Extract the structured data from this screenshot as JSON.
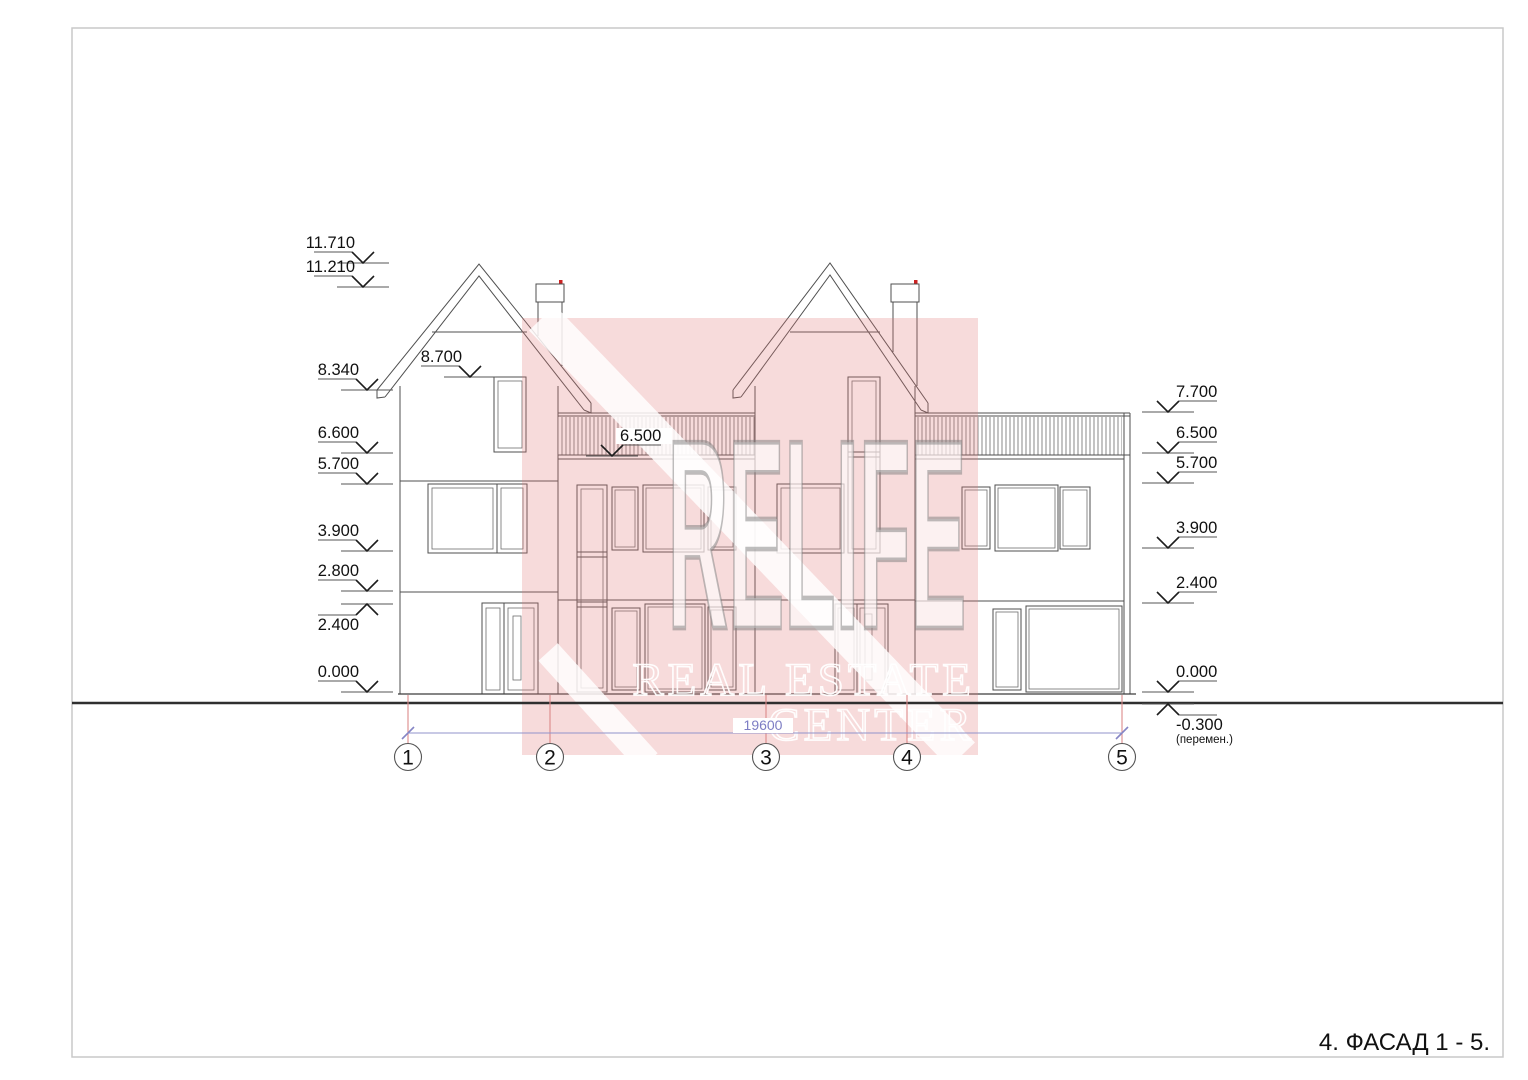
{
  "page": {
    "title": "4.  ФАСАД 1 - 5."
  },
  "watermark": {
    "line1": "RELIFE",
    "line2": "REAL ESTATE",
    "line3": "CENTER",
    "pink": "#e07a7a"
  },
  "dimension": {
    "value": "19600",
    "color": "#7d7dc4",
    "x1": 408,
    "x2": 1122,
    "y": 733,
    "label_x": 763
  },
  "axes": {
    "line_color": "#dd8a8a",
    "bubble_y": 757,
    "line_top": 695,
    "line_bottom": 744,
    "bubbles": [
      {
        "label": "1",
        "x": 408
      },
      {
        "label": "2",
        "x": 550
      },
      {
        "label": "3",
        "x": 766
      },
      {
        "label": "4",
        "x": 907
      },
      {
        "label": "5",
        "x": 1122
      }
    ]
  },
  "elevation_marks": [
    {
      "label": "11.710",
      "x": 363,
      "y": 263,
      "dir": "down",
      "side": "left"
    },
    {
      "label": "11.210",
      "x": 363,
      "y": 287,
      "dir": "down",
      "side": "left"
    },
    {
      "label": "8.340",
      "x": 367,
      "y": 390,
      "dir": "down",
      "side": "left"
    },
    {
      "label": "6.600",
      "x": 367,
      "y": 453,
      "dir": "down",
      "side": "left"
    },
    {
      "label": "5.700",
      "x": 367,
      "y": 484,
      "dir": "down",
      "side": "left"
    },
    {
      "label": "3.900",
      "x": 367,
      "y": 551,
      "dir": "down",
      "side": "left"
    },
    {
      "label": "2.800",
      "x": 367,
      "y": 591,
      "dir": "down",
      "side": "left"
    },
    {
      "label": "2.400",
      "x": 367,
      "y": 604,
      "dir": "up",
      "side": "left"
    },
    {
      "label": "0.000",
      "x": 367,
      "y": 692,
      "dir": "down",
      "side": "left"
    },
    {
      "label": "8.700",
      "x": 470,
      "y": 377,
      "dir": "down",
      "side": "left"
    },
    {
      "label": "6.500",
      "x": 612,
      "y": 456,
      "dir": "down",
      "side": "right",
      "white_bg": true
    },
    {
      "label": "7.700",
      "x": 1168,
      "y": 412,
      "dir": "down",
      "side": "right"
    },
    {
      "label": "6.500",
      "x": 1168,
      "y": 453,
      "dir": "down",
      "side": "right"
    },
    {
      "label": "5.700",
      "x": 1168,
      "y": 483,
      "dir": "down",
      "side": "right"
    },
    {
      "label": "3.900",
      "x": 1168,
      "y": 548,
      "dir": "down",
      "side": "right"
    },
    {
      "label": "2.400",
      "x": 1168,
      "y": 603,
      "dir": "down",
      "side": "right"
    },
    {
      "label": "0.000",
      "x": 1168,
      "y": 692,
      "dir": "down",
      "side": "right"
    },
    {
      "label": "-0.300",
      "x": 1168,
      "y": 704,
      "dir": "up",
      "side": "right",
      "sub": "(перемен.)"
    }
  ],
  "colors": {
    "line": "#4f4f4f",
    "ground": "#2f2f2f",
    "axis_red": "#dd8a8a",
    "dimension_purple": "#8585c5",
    "chimney_dot": "#cc2222"
  }
}
